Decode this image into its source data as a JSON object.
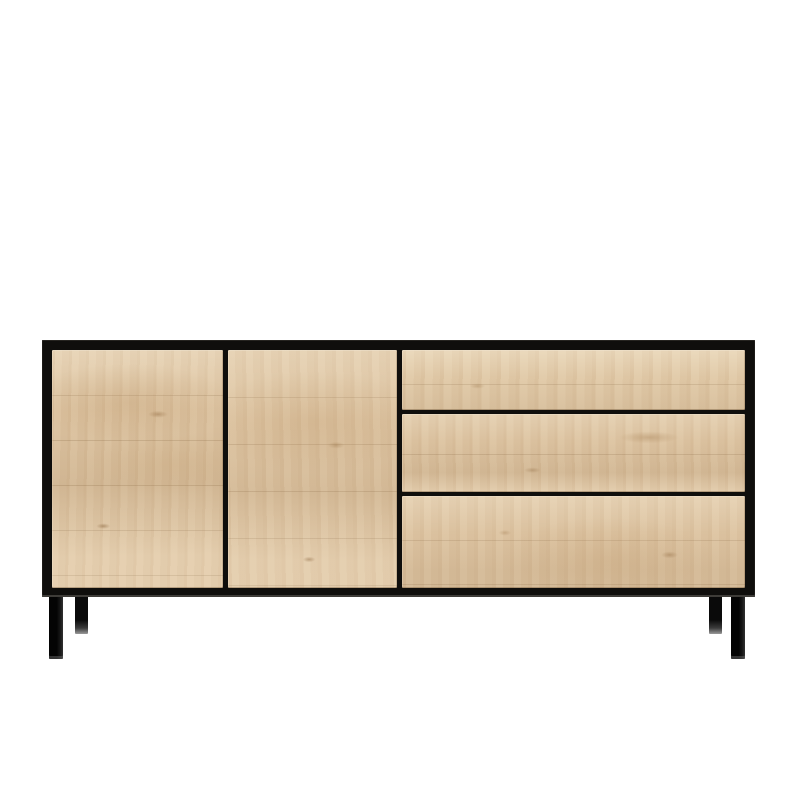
{
  "scene": {
    "type": "product-photo",
    "subject": "Oak sideboard with black metal frame, two doors, three drawers and four slim black legs",
    "background_color": "#ffffff"
  },
  "sideboard": {
    "doors": [
      {
        "label": "left door"
      },
      {
        "label": "middle door"
      }
    ],
    "drawers": [
      {
        "label": "top drawer"
      },
      {
        "label": "middle drawer"
      },
      {
        "label": "bottom drawer"
      }
    ],
    "legs": [
      {
        "label": "front-left leg"
      },
      {
        "label": "back-left leg"
      },
      {
        "label": "back-right leg"
      },
      {
        "label": "front-right leg"
      }
    ],
    "colors": {
      "frame_black": "#0f0e0c",
      "wood_base": "#dcc3a2",
      "wood_light": "#ead7ba",
      "wood_dark": "#c4a377",
      "leg_tip_highlight": "#9a9a9a",
      "base_edge_highlight": "#3e3c38",
      "background": "#ffffff"
    }
  }
}
